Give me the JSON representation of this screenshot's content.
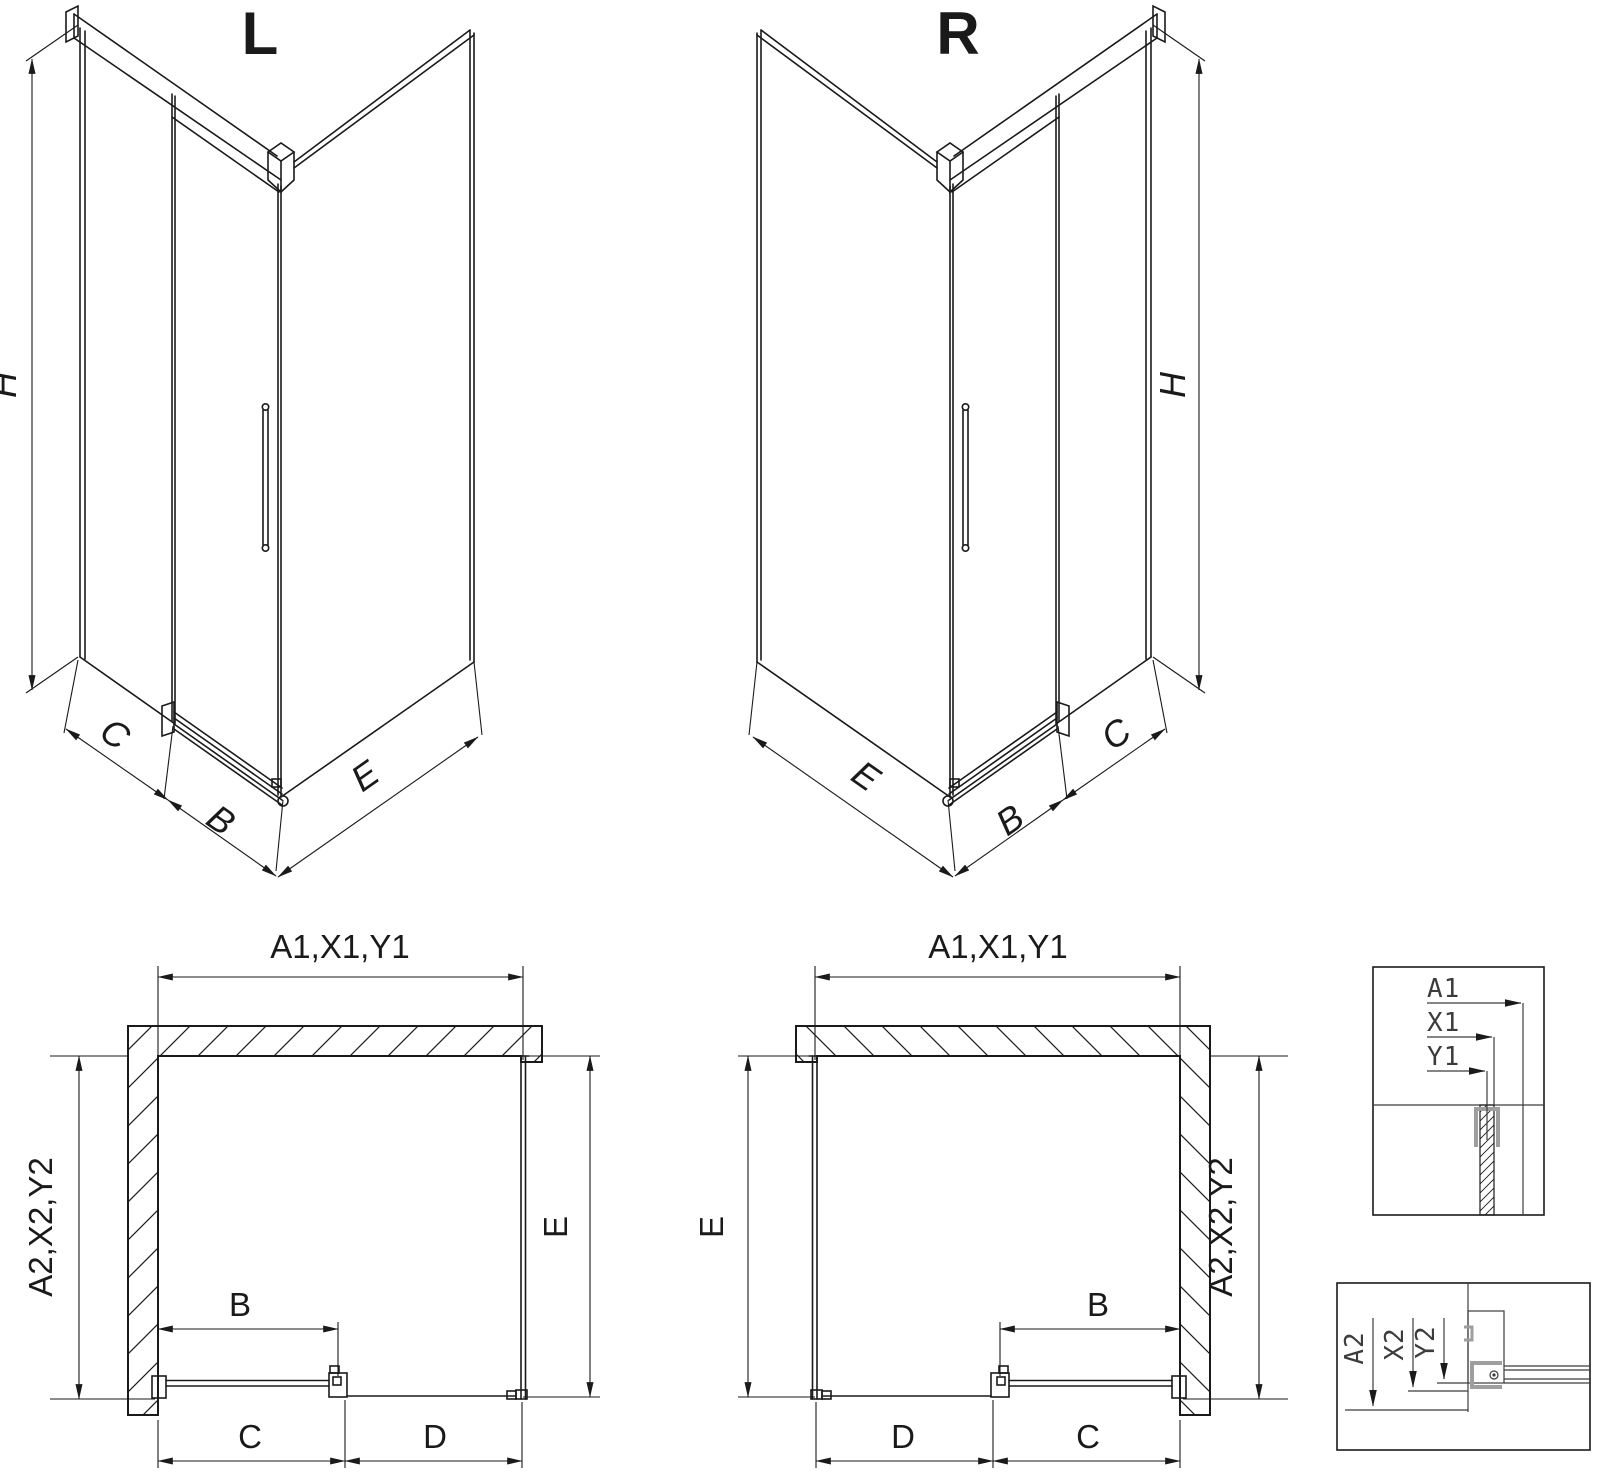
{
  "drawing": {
    "type": "shower-enclosure-technical-drawing",
    "variants": {
      "left": "L",
      "right": "R"
    }
  },
  "dim_labels": {
    "h": "H",
    "b": "B",
    "c": "C",
    "d": "D",
    "e": "E",
    "a1_group": "A1,X1,Y1",
    "a2_group": "A2,X2,Y2",
    "a1": "A1",
    "x1": "X1",
    "y1": "Y1",
    "a2": "A2",
    "x2": "X2",
    "y2": "Y2"
  },
  "colors": {
    "line": "#1a1a1a",
    "detail_line": "#3c3c3c",
    "highlight": "#9e9e9e",
    "background": "#ffffff"
  }
}
